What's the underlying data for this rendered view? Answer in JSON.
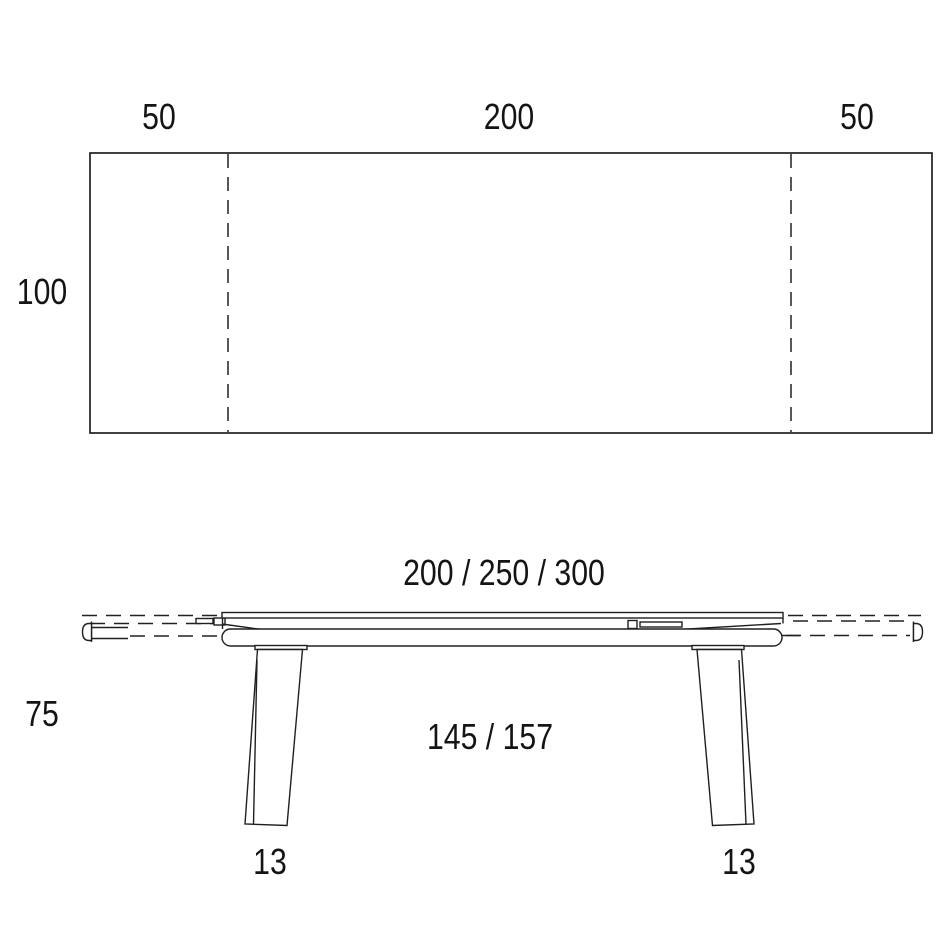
{
  "colors": {
    "background": "#ffffff",
    "line": "#202020",
    "text": "#141414"
  },
  "top_view": {
    "left_extension": "50",
    "center_length": "200",
    "right_extension": "50",
    "depth": "100"
  },
  "side_view": {
    "length_options": "200 / 250 / 300",
    "height": "75",
    "leg_clearance": "145 / 157",
    "left_leg_width": "13",
    "right_leg_width": "13"
  }
}
